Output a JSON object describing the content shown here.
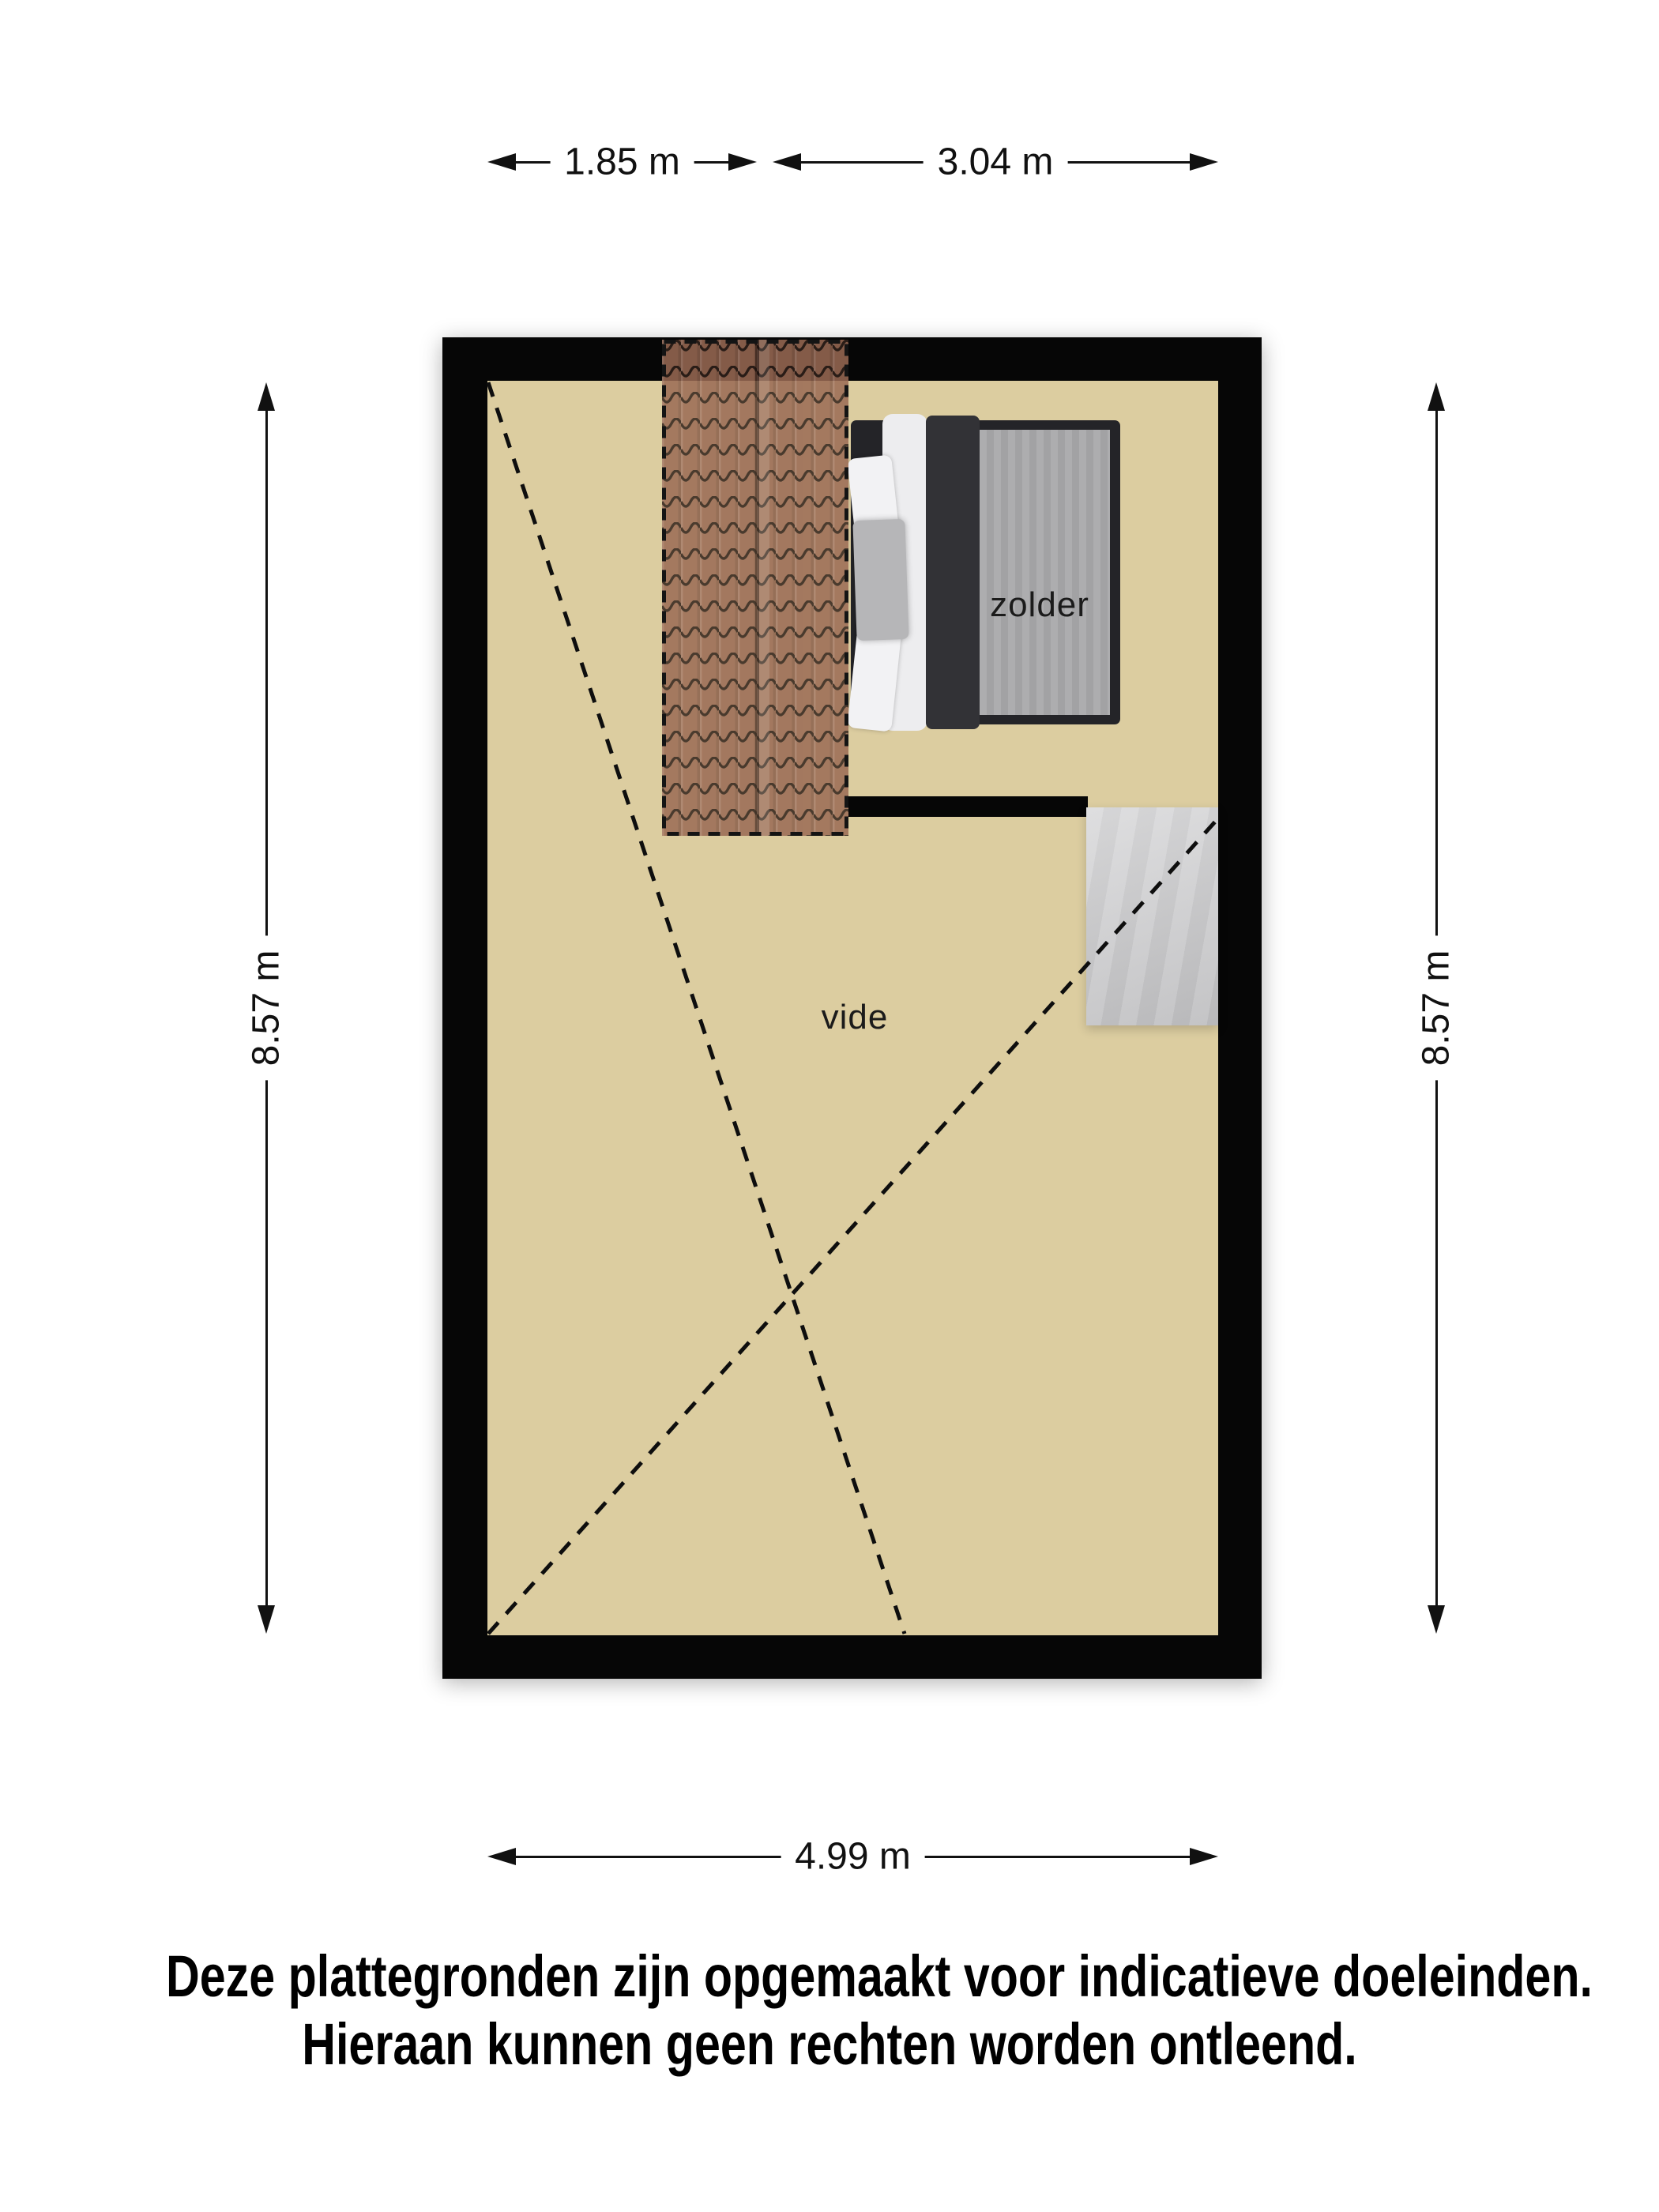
{
  "labels": {
    "room_zolder": "zolder",
    "room_vide": "vide"
  },
  "dimensions": {
    "top_left": "1.85 m",
    "top_right": "3.04 m",
    "side_left": "8.57 m",
    "side_right": "8.57 m",
    "bottom": "4.99 m"
  },
  "disclaimer": {
    "line1": "Deze plattegronden zijn opgemaakt voor indicatieve doeleinden.",
    "line2": "Hieraan kunnen geen rechten worden ontleend."
  },
  "colors": {
    "floor": "#dccda0",
    "wall": "#060606",
    "tile": "#9a6a54",
    "tile_line": "#30211a",
    "bed_frame": "#242428",
    "bed_band": "#323236",
    "bed_white": "#ededef",
    "bed_blanket": "#a9a9ab",
    "pillow_light": "#f2f2f4",
    "pillow_gray": "#b6b6b8",
    "stairs": "#cacacc",
    "dash": "#0e0e0e",
    "dim": "#111111",
    "text": "#000000"
  }
}
